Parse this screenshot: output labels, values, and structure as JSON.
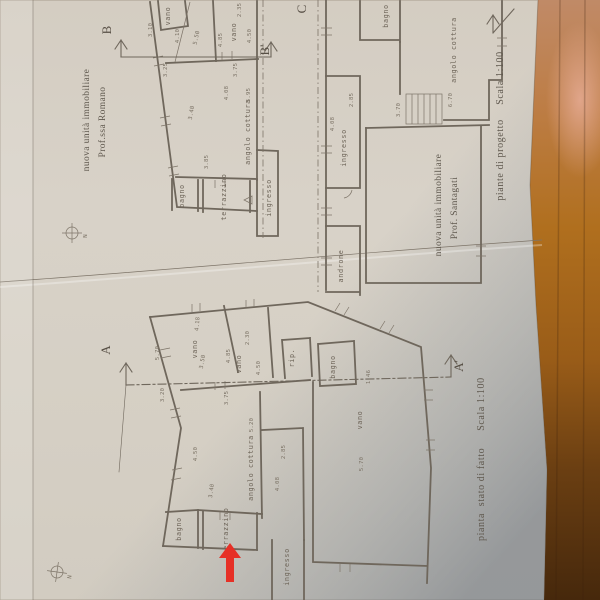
{
  "compass": {
    "label": "N"
  },
  "plan_romano": {
    "owner_line1": "nuova unità immobiliare",
    "owner_line2": "Prof.ssa Romano",
    "section_start": "B",
    "section_end": "B'",
    "rooms": {
      "vano_top": "vano",
      "vano_right": "vano",
      "angolo_cottura": "angolo cottura",
      "bagno": "bagno",
      "terrazzino": "terrazzino",
      "ingresso": "ingresso"
    },
    "dims": {
      "d1": "3.10",
      "d2": "4.10",
      "d3": "5.50",
      "d4": "4.85",
      "d5": "2.35",
      "d6": "4.50",
      "d7": "3.25",
      "d8": "3.75",
      "d9": "4.08",
      "d10": "3.40",
      "d11": "3.85",
      "d12": "5.95"
    }
  },
  "plan_santagati": {
    "owner_line1": "nuova unità immobiliare",
    "owner_line2": "Prof. Santagati",
    "caption": "piante di progetto",
    "scale": "Scala 1:100",
    "section_start": "C",
    "rooms": {
      "bagno": "bagno",
      "angolo_cottura": "angolo cottura",
      "ingresso": "ingresso",
      "androne": "androne"
    },
    "dims": {
      "d1": "2.85",
      "d2": "4.08",
      "d3": "3.70",
      "d4": "6.70"
    }
  },
  "plan_stato": {
    "caption_word1": "pianta",
    "caption_word2": "stato di fatto",
    "scale": "Scala 1:100",
    "section_start": "A",
    "section_end": "A'",
    "rooms": {
      "vano_a": "vano",
      "vano_b": "vano",
      "rip": "rip.",
      "bagno_top": "bagno",
      "vano_c": "vano",
      "angolo_cottura": "angolo cottura",
      "bagno": "bagno",
      "terrazzino": "terrazzino",
      "ingresso": "ingresso"
    },
    "dims": {
      "d1": "4.18",
      "d2": "5.70",
      "d3": "3.50",
      "d4": "4.85",
      "d5": "2.30",
      "d6": "4.50",
      "d7": "3.20",
      "d8": "3.75",
      "d9": "4.08",
      "d10": "5.20",
      "d11": "3.40",
      "d12": "2.85",
      "d13": "5.70",
      "d14": "1.46",
      "d15": "4.50"
    }
  },
  "colors": {
    "paper": "#d7d1c6",
    "paper_shadow": "#99a0a6",
    "ink": "#6f675c",
    "wood_light": "#c4845a",
    "wood_mid": "#b06f1e",
    "wood_dark": "#4a2a0c",
    "red_arrow": "#e63026"
  }
}
